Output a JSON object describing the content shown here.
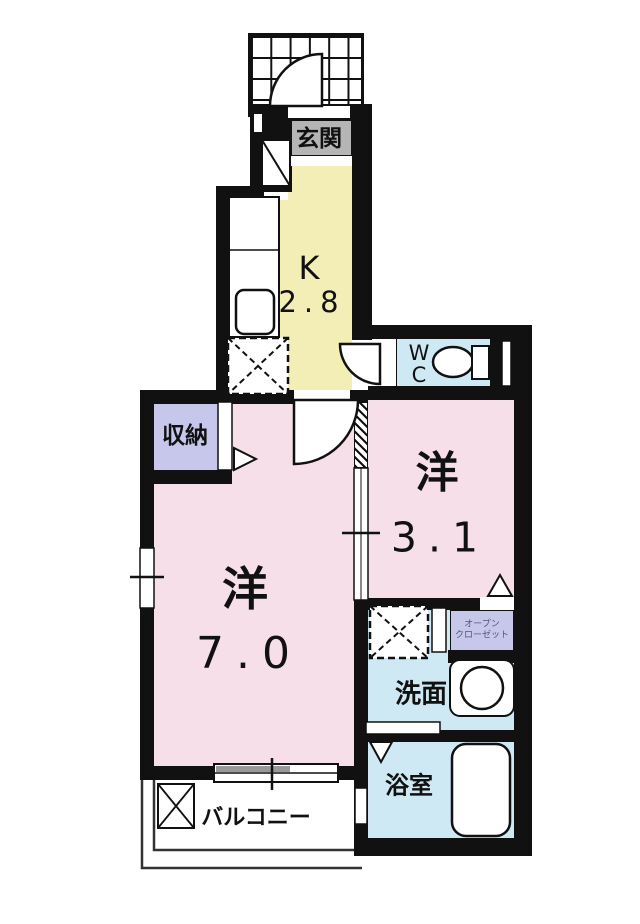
{
  "plan_title": "1K apartment floor plan",
  "colors": {
    "wall": "#111111",
    "kitchen_floor": "#f3eeb5",
    "room_floor": "#f7dfe9",
    "wet_area_floor": "#cfe9f4",
    "closet_floor": "#c7c7ec",
    "label_box_gray": "#b5b5b5",
    "balcony_line": "#333333"
  },
  "rooms": {
    "genkan": {
      "label": "玄関"
    },
    "kitchen": {
      "label": "K",
      "size": "2.8"
    },
    "wc": {
      "line1": "W",
      "line2": "C"
    },
    "storage": {
      "label": "収納"
    },
    "western7": {
      "label": "洋",
      "size": "7.0"
    },
    "western3": {
      "label": "洋",
      "size": "3.1"
    },
    "open_closet": {
      "line1": "オープン",
      "line2": "クローゼット"
    },
    "washroom": {
      "label": "洗面"
    },
    "bathroom": {
      "label": "浴室"
    },
    "balcony": {
      "label": "バルコニー"
    }
  }
}
